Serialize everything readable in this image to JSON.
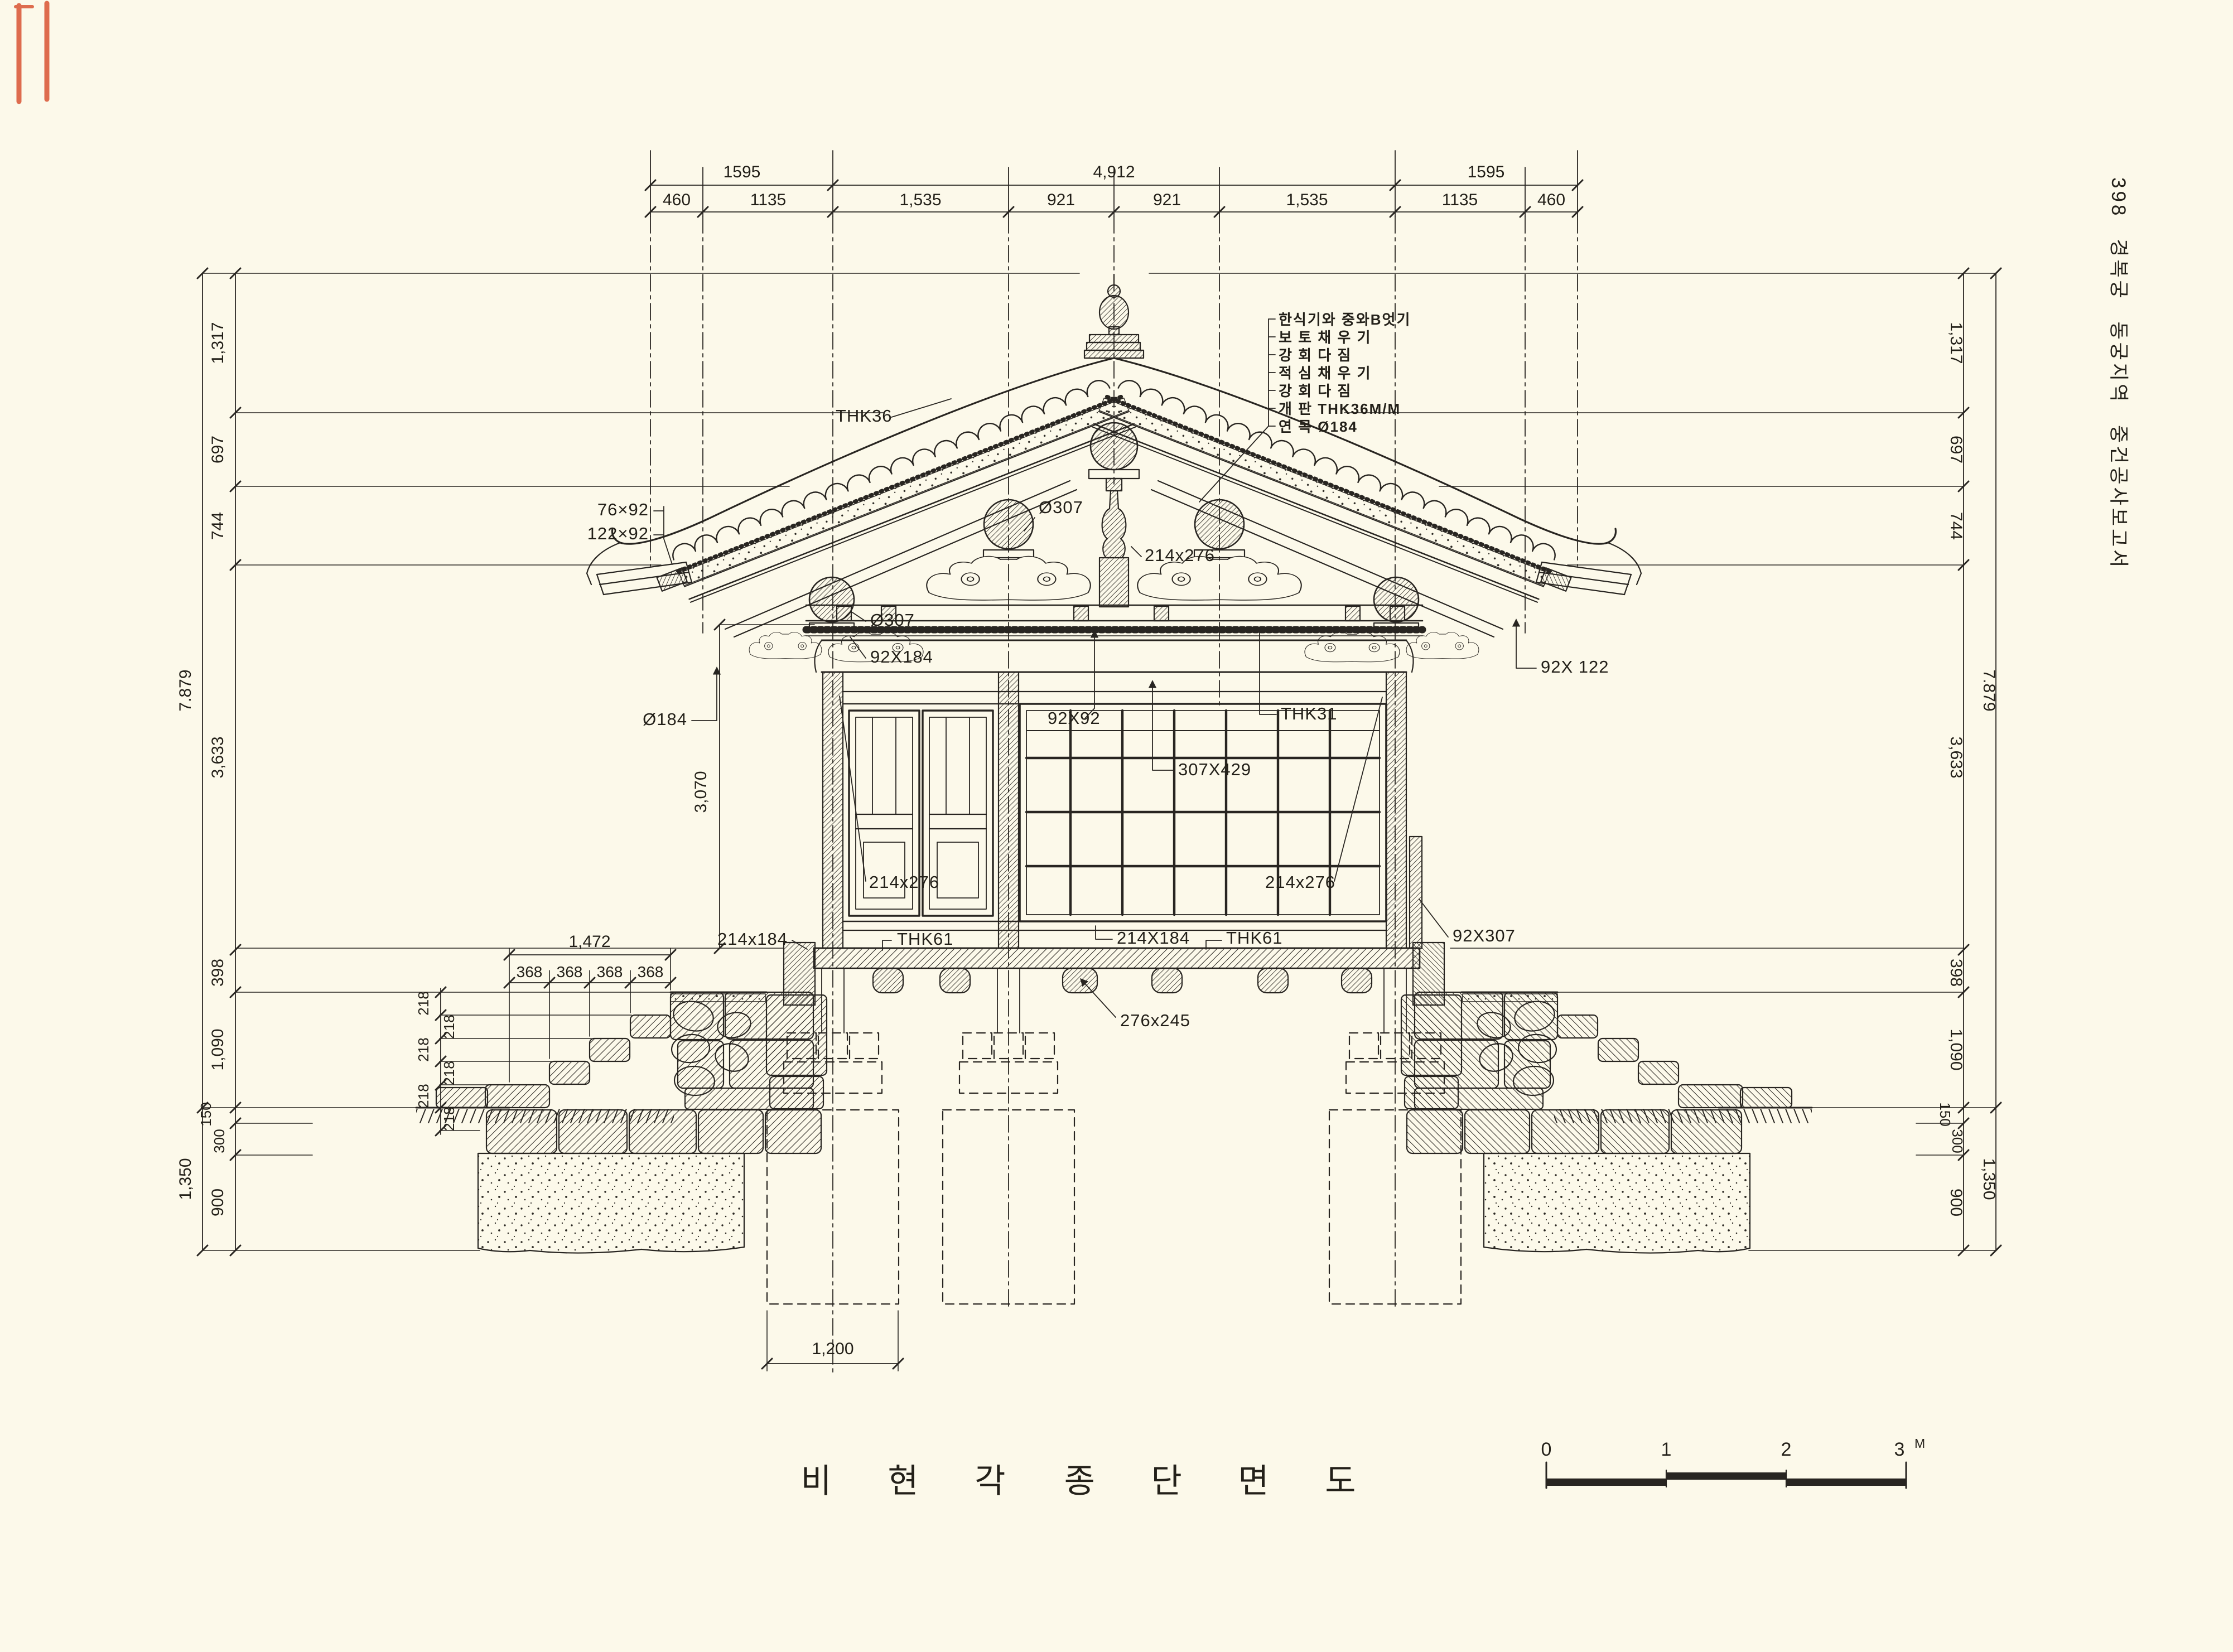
{
  "page": {
    "side_caption": "398  경복궁 동궁지역 중건공사보고서",
    "title_left": "비 현 각",
    "title_right": "종 단 면 도"
  },
  "colors": {
    "paper": "#fcf9ea",
    "ink": "#282521",
    "red_mark": "#d95433"
  },
  "dims": {
    "top_row1": [
      "1595",
      "4,912",
      "1595"
    ],
    "top_row2": [
      "460",
      "1135",
      "1,535",
      "921",
      "921",
      "1,535",
      "1135",
      "460"
    ],
    "left_inner": [
      "1,317",
      "697",
      "744",
      "3,633",
      "398",
      "1,090",
      "150",
      "300",
      "900"
    ],
    "left_outer": [
      "7.879",
      "1,350"
    ],
    "right_inner": [
      "1,317",
      "697",
      "744",
      "3,633",
      "398",
      "1,090",
      "150",
      "300",
      "900"
    ],
    "right_outer": [
      "7.879",
      "1,350"
    ],
    "stair_total": "1,472",
    "stair_treads": [
      "368",
      "368",
      "368",
      "368"
    ],
    "stair_risers": [
      "218",
      "218",
      "218",
      "218",
      "218",
      "218"
    ],
    "footing_width": "1,200",
    "column_height": "3,070"
  },
  "labels": {
    "thk36": "THK36",
    "rafter_a": "76×92",
    "rafter_b": "122×92",
    "dia307_ridge": "Ø307",
    "kingpost_214x276": "214x276",
    "dia307_purlin": "Ø307",
    "plate_92x184": "92X184",
    "soro_92x92": "92X92",
    "thk31": "THK31",
    "beam_307x429": "307X429",
    "bracket_left_214x276": "214x276",
    "bracket_right_214x276": "214x276",
    "eave_92x122": "92X 122",
    "rafter_dia184": "Ø184",
    "sill_left": "214x184",
    "floor_thk_left": "THK61",
    "sill_right": "214X184",
    "floor_thk_right": "THK61",
    "board_92x307": "92X307",
    "joist_276x245": "276x245"
  },
  "annotation_list": [
    "한식기와 중와B엇기",
    "보 토 채 우 기",
    "강 회 다 짐",
    "적 심 채 우 기",
    "강 회 다 짐",
    "개 판 THK36M/M",
    "연 목 Ø184"
  ],
  "scale_bar": {
    "ticks": [
      "0",
      "1",
      "2",
      "3"
    ],
    "unit": "M"
  }
}
